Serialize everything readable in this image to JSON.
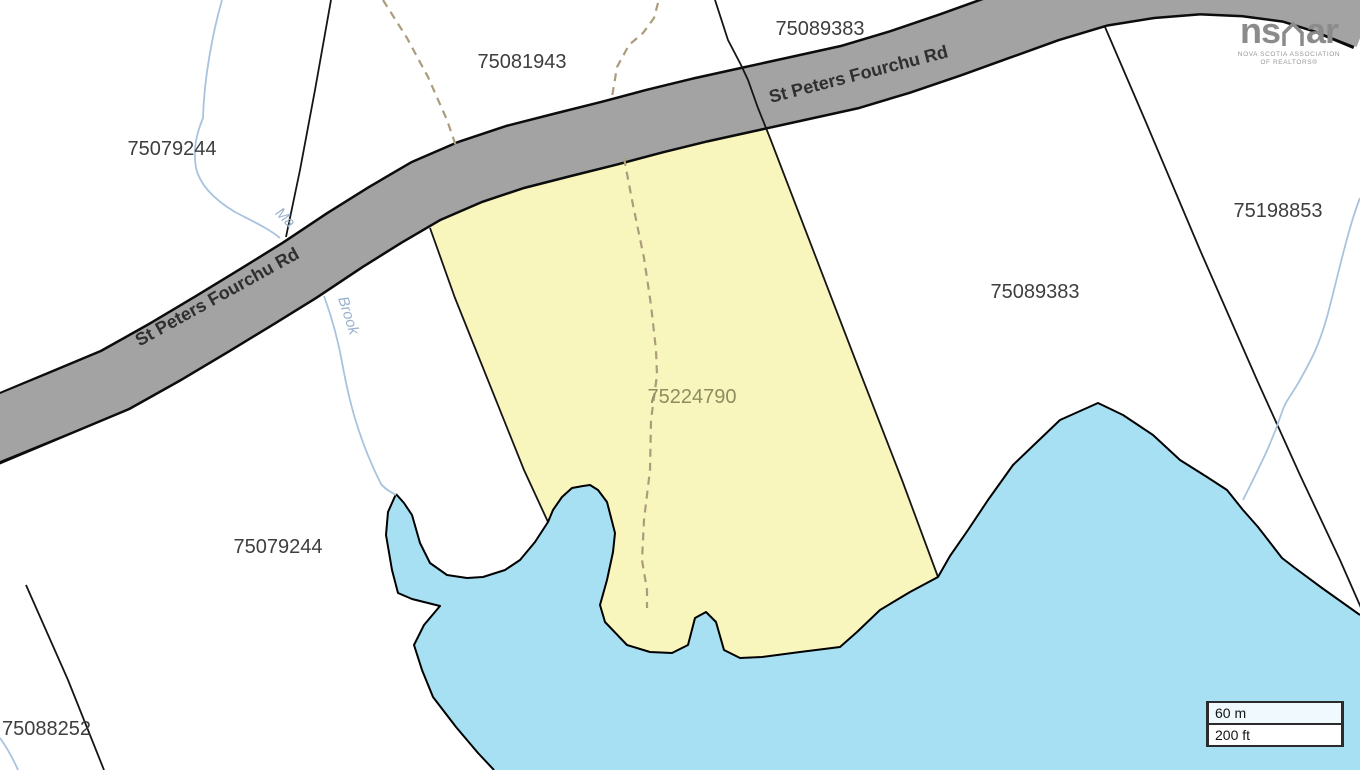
{
  "map_labels": {
    "road_name": "St Peters Fourchu Rd",
    "brook_name_upper": "Ma",
    "brook_name_lower": "Brook",
    "subject_parcel_id": "75224790",
    "parcel_ids": {
      "upper_left": "75079244",
      "top_center": "75081943",
      "top_right": "75089383",
      "right": "75198853",
      "mid_right": "75089383",
      "lower_left": "75079244",
      "bottom_left_corner": "75088252"
    }
  },
  "scale_bar": {
    "metric_label": "60 m",
    "imperial_label": "200 ft"
  },
  "watermark": {
    "logo_left": "ns",
    "logo_right": "ar",
    "caption_line1": "NOVA SCOTIA ASSOCIATION",
    "caption_line2": "OF REALTORS®"
  },
  "colors": {
    "subject_parcel_fill": "#f8f5bd",
    "water_fill": "#a7e0f2",
    "road_fill": "#a3a3a3"
  }
}
